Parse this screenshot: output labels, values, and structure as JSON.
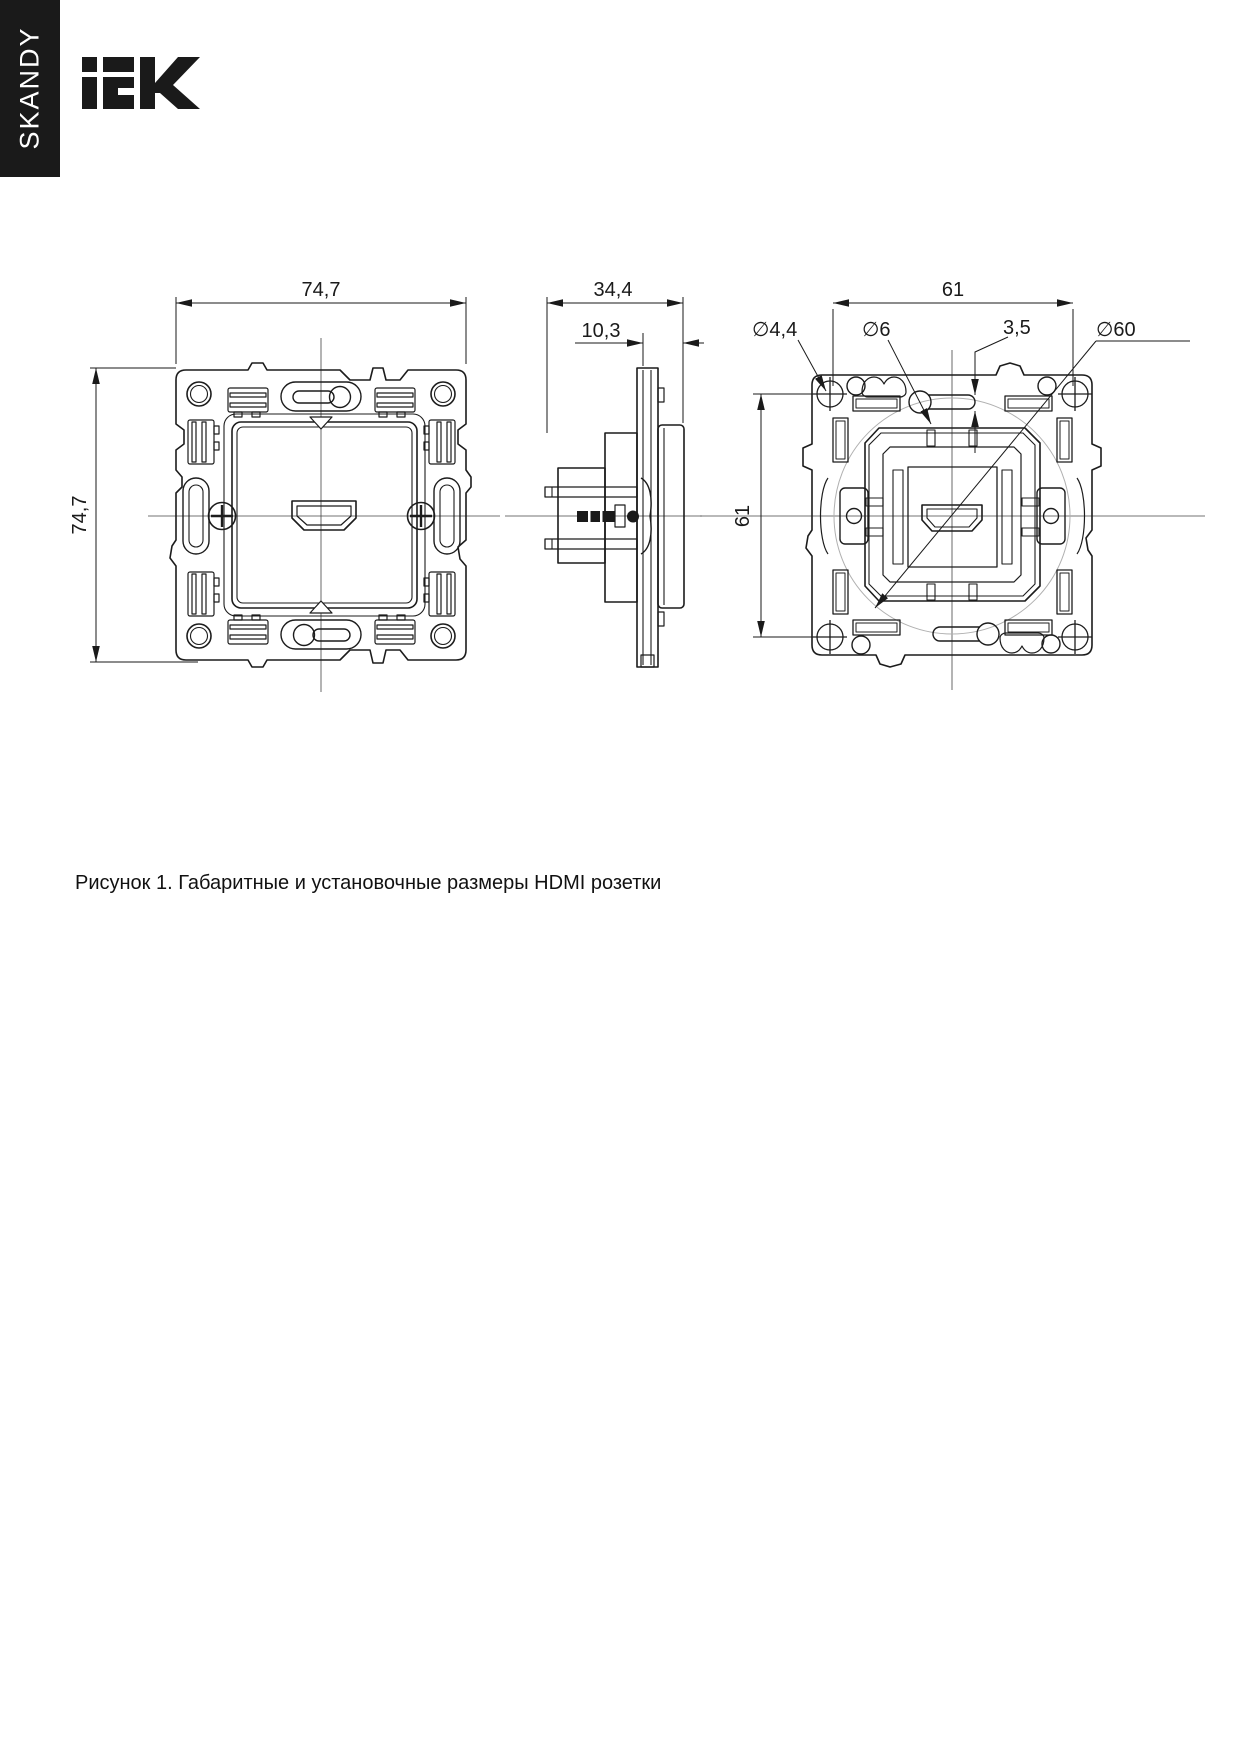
{
  "banner": {
    "series": "SKANDY"
  },
  "brand": {
    "name": "IEK"
  },
  "drawing": {
    "front_view": {
      "dim_width": "74,7",
      "dim_height": "74,7"
    },
    "side_view": {
      "dim_depth": "34,4",
      "dim_protrusion": "10,3"
    },
    "back_view": {
      "dim_mount_width": "61",
      "dim_mount_height": "61",
      "dim_screw_hole": "∅4,4",
      "dim_center_hole": "∅6",
      "dim_slot_width": "3,5",
      "dim_mount_circle": "∅60"
    }
  },
  "caption": "Рисунок 1. Габаритные и установочные размеры HDMI розетки"
}
